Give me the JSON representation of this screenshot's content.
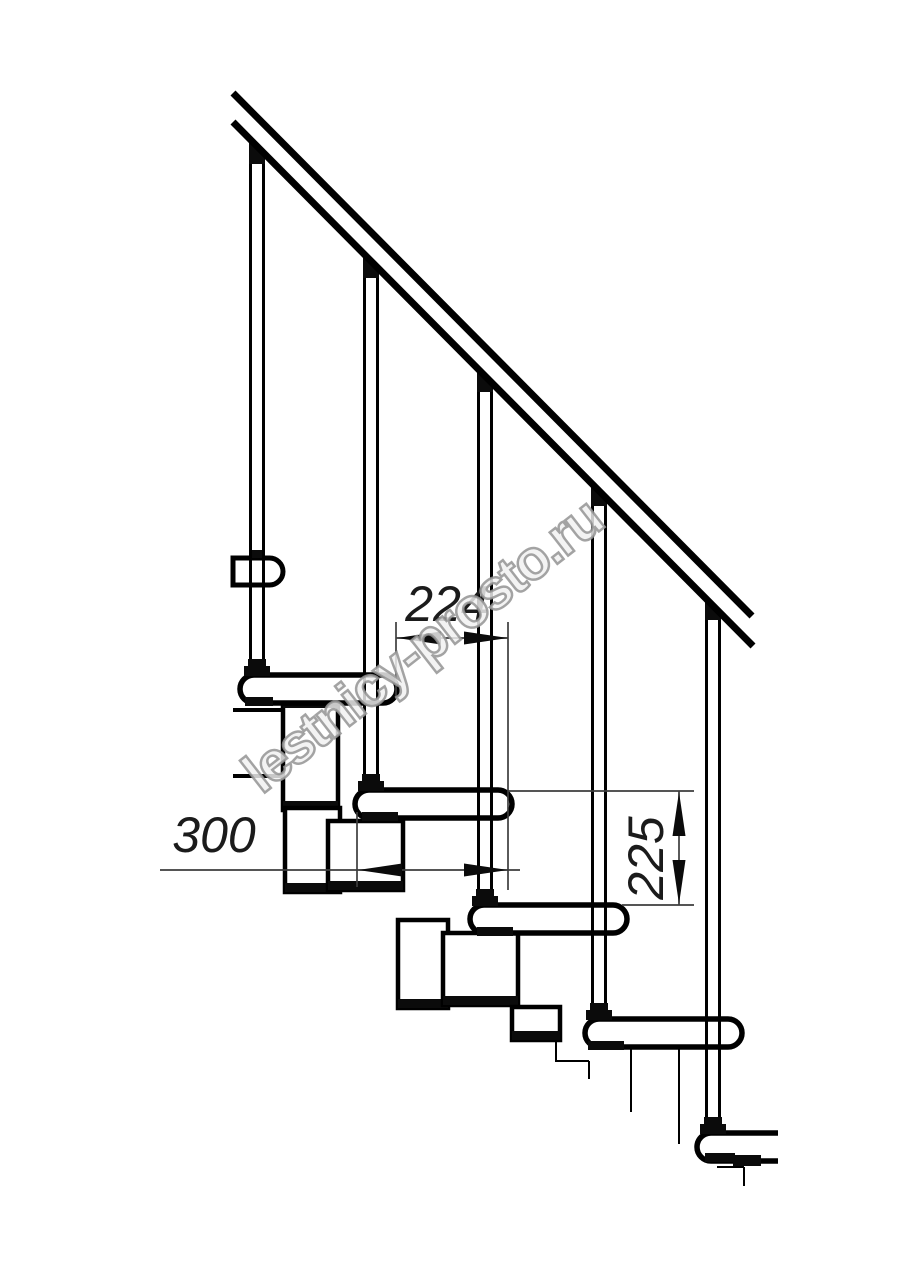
{
  "drawing": {
    "title": "Modular staircase side elevation - technical drawing",
    "watermark": "lestnicy-prosto.ru",
    "dimensions": {
      "run": "224",
      "tread_depth": "300",
      "rise": "225"
    },
    "colors": {
      "ink": "#000000",
      "dimension_lines": "#3d3d3d",
      "background": "#ffffff",
      "watermark_stroke": "#949494"
    }
  }
}
